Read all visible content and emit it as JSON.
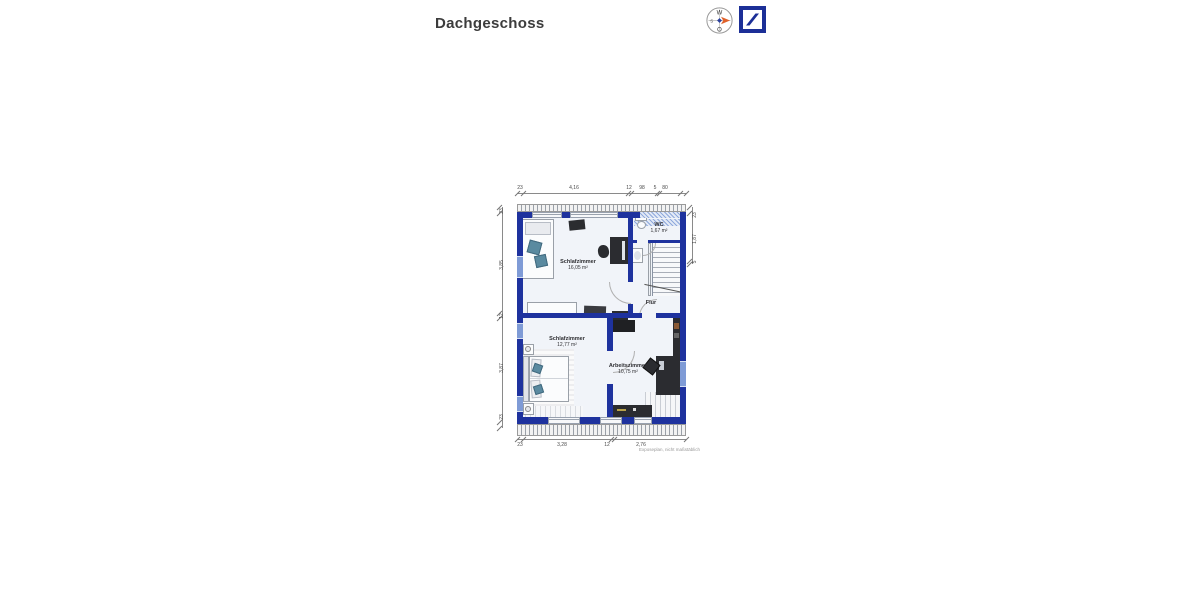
{
  "title": "Dachgeschoss",
  "compass": {
    "top": "W",
    "left": "S",
    "bottom": "O"
  },
  "plan": {
    "rooms": [
      {
        "name": "Schlafzimmer",
        "area": "16,05 m²"
      },
      {
        "name": "WC",
        "area": "1,67 m²"
      },
      {
        "name": "Flur",
        "area": ""
      },
      {
        "name": "Schlafzimmer",
        "area": "12,77 m²"
      },
      {
        "name": "Arbeitszimmer",
        "area": "10,75 m²"
      }
    ],
    "dimensions": {
      "top": [
        "23",
        "4,16",
        "12",
        "98",
        "5",
        "80"
      ],
      "bottom": [
        "23",
        "3,28",
        "12",
        "2,76"
      ],
      "left": [
        "23",
        "3,85",
        "12",
        "3,87",
        "23"
      ],
      "right": [
        "23",
        "1,87",
        "5"
      ]
    },
    "footnote": "Exposeplan, nicht maßstäblich"
  },
  "colors": {
    "wall": "#1e329e",
    "window_blue": "#7f9bd6",
    "compass_arrow": "#e0622b",
    "logo_blue": "#1c2f97"
  }
}
